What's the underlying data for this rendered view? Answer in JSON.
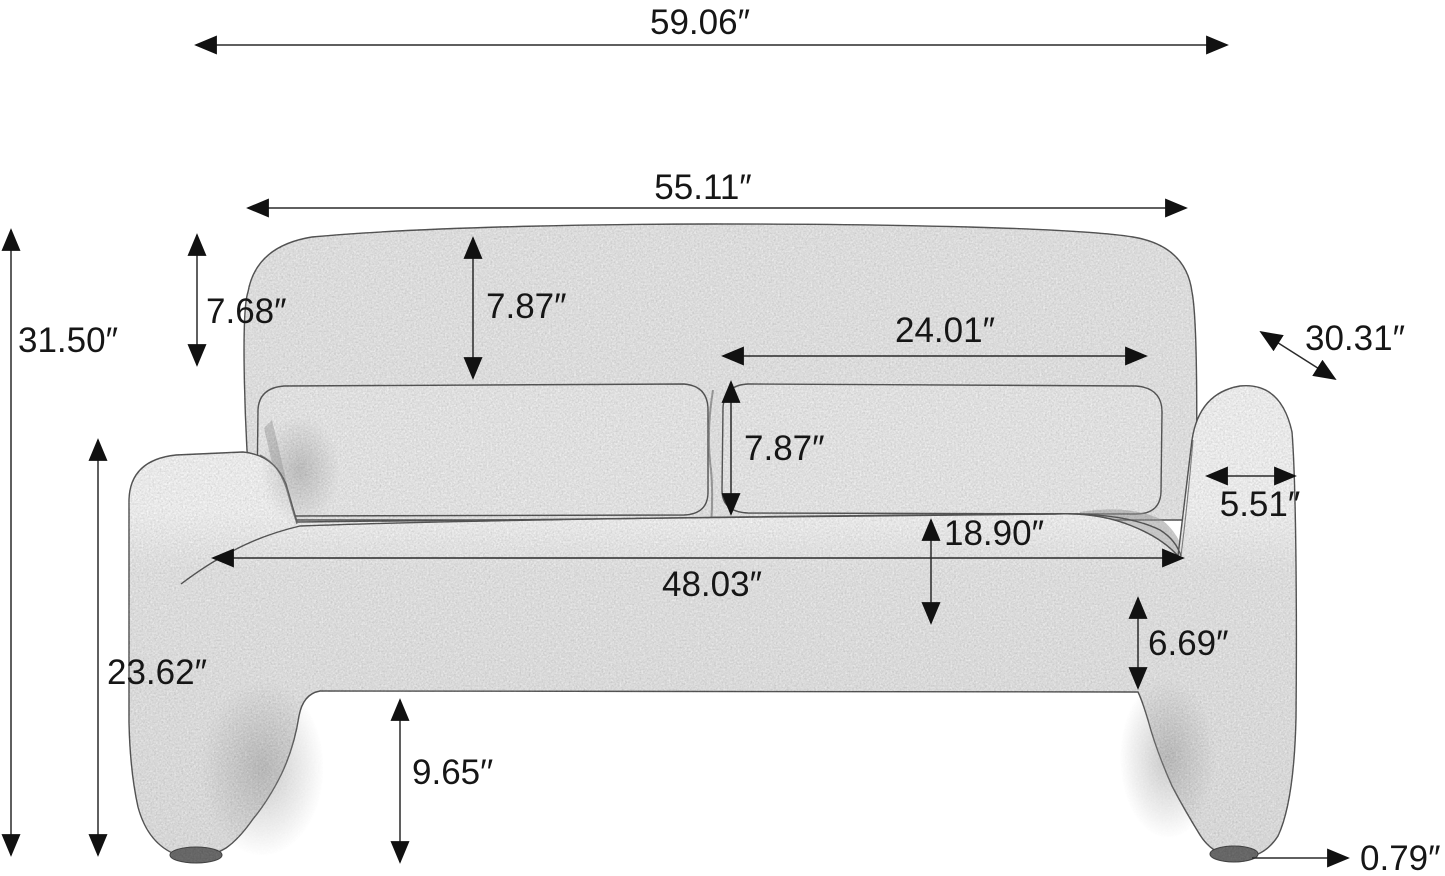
{
  "figure": {
    "kind": "product dimension diagram",
    "subject": "boucle loveseat sofa, front view line drawing"
  },
  "colors": {
    "ink": "#2a2a2a",
    "fabric_light": "#eeeeee",
    "fabric_highlight": "#f8f8f8",
    "foot": "#6f6f6f",
    "background": "#ffffff"
  },
  "dims": {
    "overall_width": "59.06″",
    "back_width": "55.11″",
    "overall_height": "31.50″",
    "headrest_height": "7.68″",
    "back_top_height": "7.87″",
    "cushion_width": "24.01″",
    "depth_diagonal": "30.31″",
    "back_cushion_height": "7.87″",
    "arm_width": "5.51″",
    "seat_depth": "18.90″",
    "seat_width": "48.03″",
    "seat_front_height": "6.69″",
    "arm_height": "23.62″",
    "leg_height": "9.65′′",
    "foot_height": "0.79″"
  }
}
